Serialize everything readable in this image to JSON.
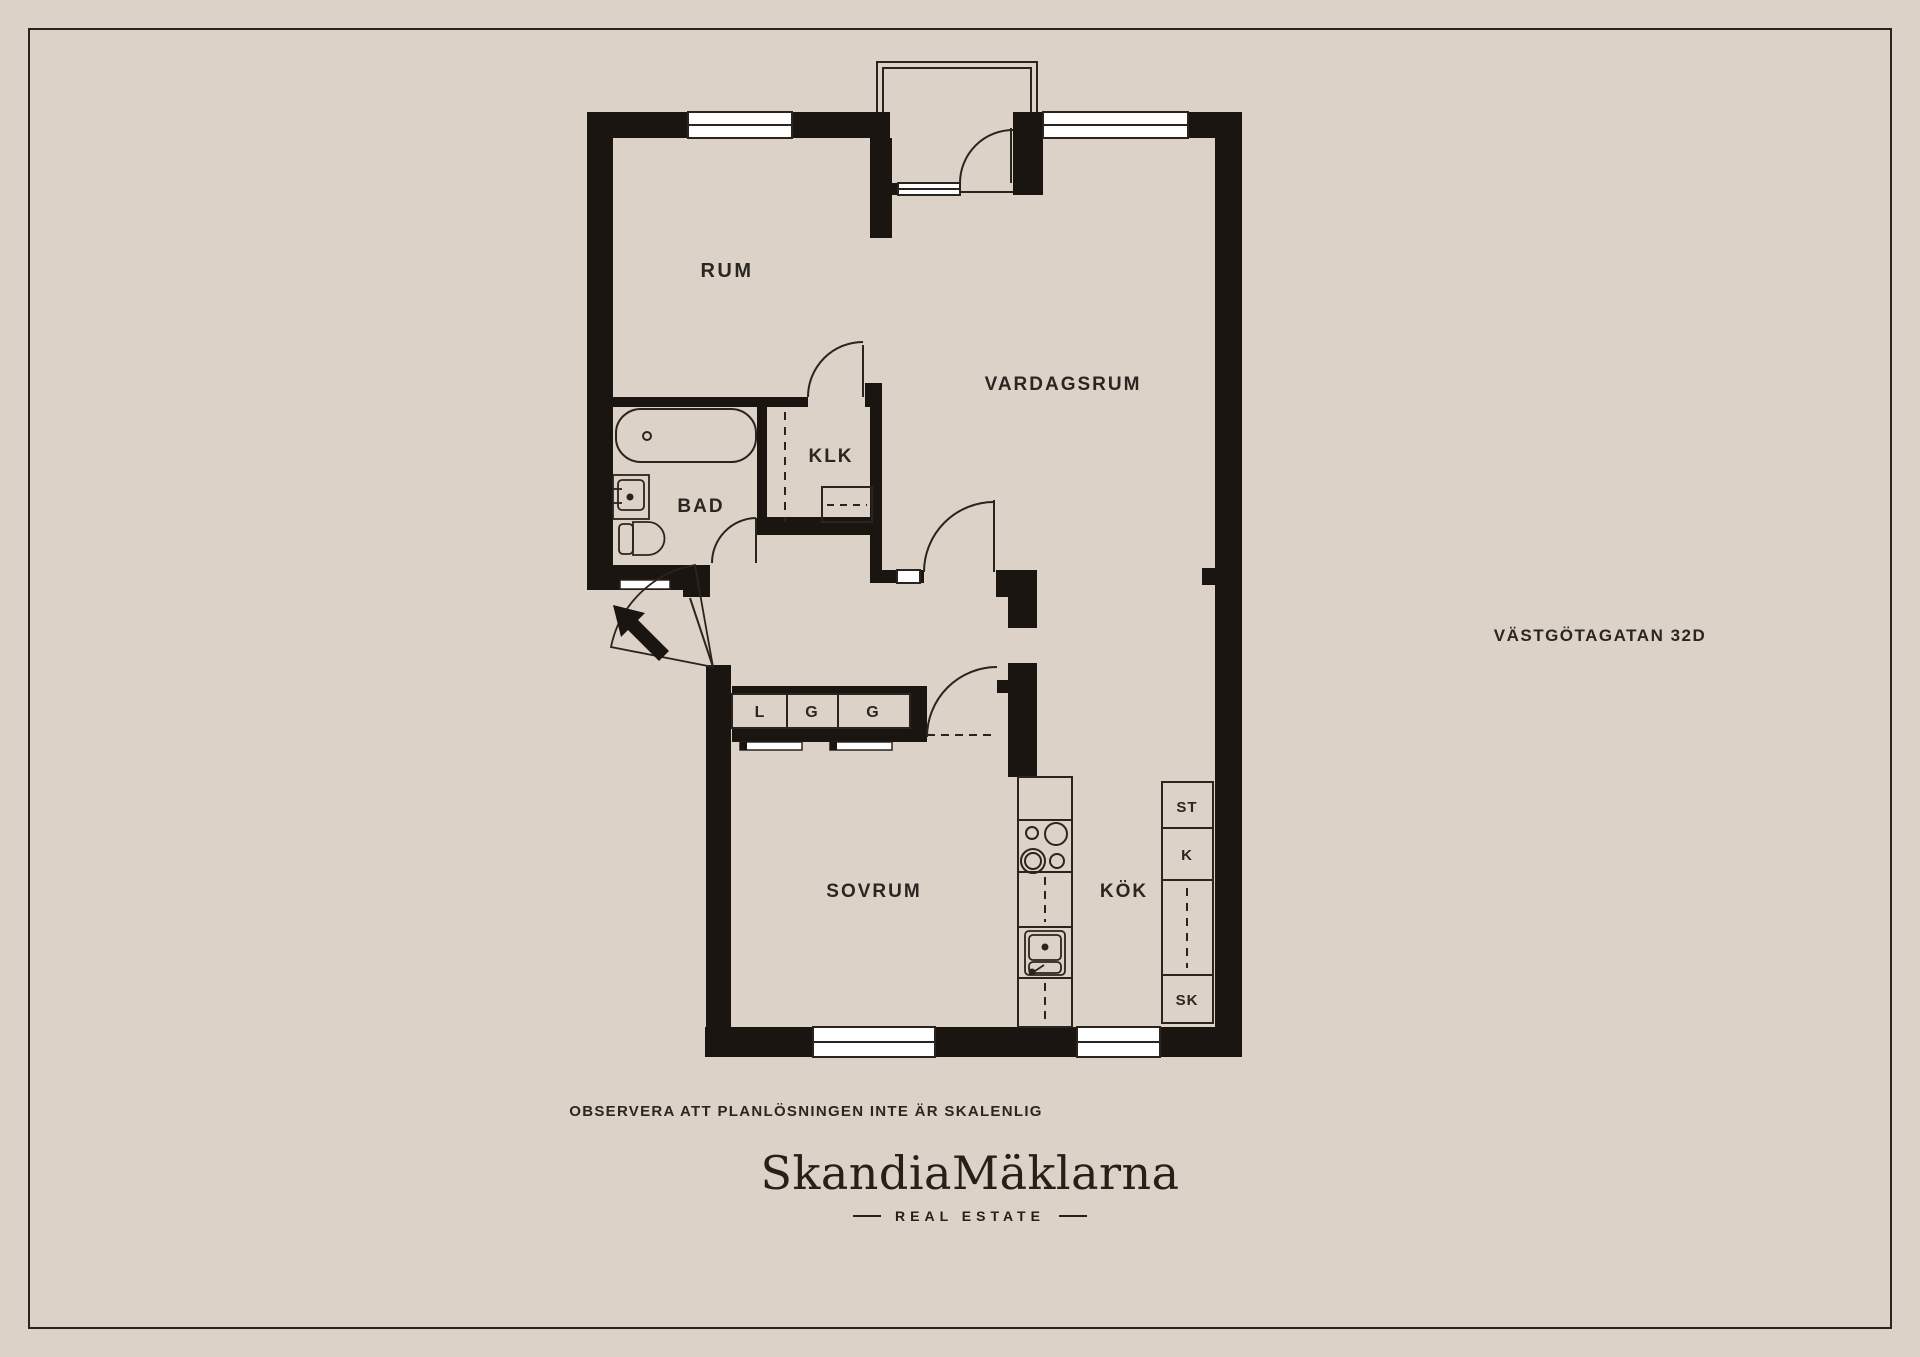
{
  "page": {
    "background_color": "#dcd2c7",
    "wall_color": "#1a1511",
    "line_color": "#2b241e",
    "window_color": "#ffffff"
  },
  "floor_plan": {
    "address": "VÄSTGÖTAGATAN 32D",
    "disclaimer": "OBSERVERA ATT PLANLÖSNINGEN INTE ÄR SKALENLIG",
    "rooms": {
      "rum": "RUM",
      "vardagsrum": "VARDAGSRUM",
      "klk": "KLK",
      "bad": "BAD",
      "sovrum": "SOVRUM",
      "kok": "KÖK"
    },
    "closet_labels": [
      "L",
      "G",
      "G"
    ],
    "cabinet_labels": [
      "ST",
      "K",
      "SK"
    ]
  },
  "footer": {
    "brand": "SkandiaMäklarna",
    "tagline": "REAL ESTATE"
  }
}
